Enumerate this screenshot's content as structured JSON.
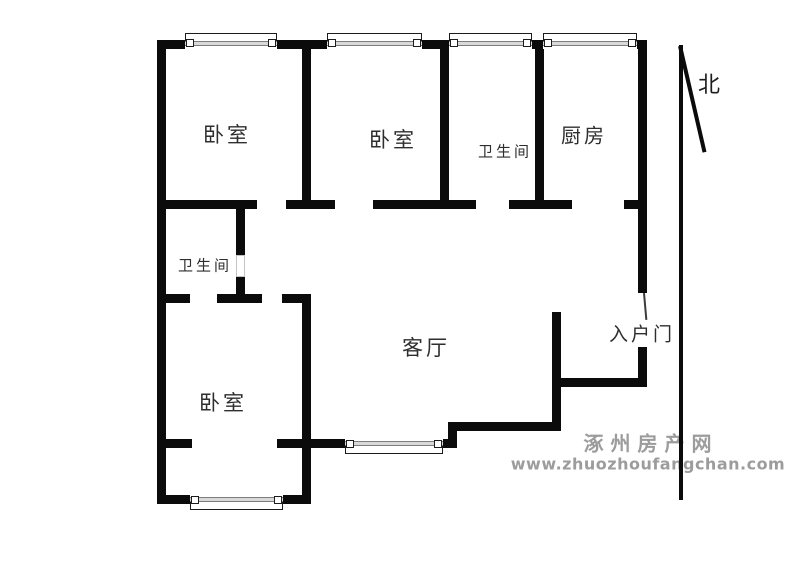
{
  "canvas": {
    "w": 800,
    "h": 570,
    "bg": "#ffffff"
  },
  "colors": {
    "wall": "#0b0b0b",
    "label": "#2e2e2e",
    "watermark": "#9c9c9c",
    "window_frame": "#1c1c1c",
    "window_glass": "#7d7d7d",
    "door_outline": "#c4c4c4"
  },
  "rooms": [
    {
      "name": "bedroom-northwest",
      "label": "卧室",
      "cx": 227,
      "cy": 134,
      "fs": 21
    },
    {
      "name": "bedroom-north",
      "label": "卧室",
      "cx": 393,
      "cy": 139,
      "fs": 21
    },
    {
      "name": "bathroom-north",
      "label": "卫生间",
      "cx": 505,
      "cy": 151,
      "fs": 15
    },
    {
      "name": "kitchen",
      "label": "厨房",
      "cx": 584,
      "cy": 134,
      "fs": 20
    },
    {
      "name": "bathroom-west",
      "label": "卫生间",
      "cx": 205,
      "cy": 265,
      "fs": 15
    },
    {
      "name": "bedroom-southwest",
      "label": "卧室",
      "cx": 223,
      "cy": 402,
      "fs": 21
    },
    {
      "name": "living-room",
      "label": "客厅",
      "cx": 426,
      "cy": 347,
      "fs": 21
    },
    {
      "name": "entry-door",
      "label": "入户门",
      "cx": 642,
      "cy": 333,
      "fs": 19
    }
  ],
  "north": {
    "label": "北",
    "cx": 709,
    "cy": 83,
    "vline": {
      "x": 679,
      "y": 45,
      "w": 4,
      "h": 455
    },
    "dline": {
      "x": 678,
      "y": 46,
      "w": 4,
      "h": 109,
      "angle": -13
    }
  },
  "walls": [
    {
      "x": 157,
      "y": 40,
      "w": 28,
      "h": 9
    },
    {
      "x": 277,
      "y": 40,
      "w": 50,
      "h": 9
    },
    {
      "x": 422,
      "y": 40,
      "w": 27,
      "h": 9
    },
    {
      "x": 532,
      "y": 40,
      "w": 11,
      "h": 9
    },
    {
      "x": 637,
      "y": 40,
      "w": 10,
      "h": 9
    },
    {
      "x": 157,
      "y": 40,
      "w": 9,
      "h": 464
    },
    {
      "x": 638,
      "y": 40,
      "w": 9,
      "h": 253
    },
    {
      "x": 302,
      "y": 49,
      "w": 9,
      "h": 151
    },
    {
      "x": 440,
      "y": 49,
      "w": 9,
      "h": 151
    },
    {
      "x": 535,
      "y": 49,
      "w": 9,
      "h": 151
    },
    {
      "x": 157,
      "y": 200,
      "w": 100,
      "h": 9
    },
    {
      "x": 286,
      "y": 200,
      "w": 49,
      "h": 9
    },
    {
      "x": 373,
      "y": 200,
      "w": 103,
      "h": 9
    },
    {
      "x": 509,
      "y": 200,
      "w": 63,
      "h": 9
    },
    {
      "x": 624,
      "y": 200,
      "w": 23,
      "h": 9
    },
    {
      "x": 236,
      "y": 209,
      "w": 9,
      "h": 46
    },
    {
      "x": 236,
      "y": 277,
      "w": 9,
      "h": 17
    },
    {
      "x": 157,
      "y": 294,
      "w": 33,
      "h": 9
    },
    {
      "x": 217,
      "y": 294,
      "w": 45,
      "h": 9
    },
    {
      "x": 282,
      "y": 294,
      "w": 29,
      "h": 9
    },
    {
      "x": 302,
      "y": 303,
      "w": 9,
      "h": 201
    },
    {
      "x": 157,
      "y": 439,
      "w": 35,
      "h": 9
    },
    {
      "x": 277,
      "y": 439,
      "w": 68,
      "h": 9
    },
    {
      "x": 443,
      "y": 439,
      "w": 14,
      "h": 9
    },
    {
      "x": 448,
      "y": 422,
      "w": 9,
      "h": 17
    },
    {
      "x": 457,
      "y": 422,
      "w": 104,
      "h": 9
    },
    {
      "x": 552,
      "y": 312,
      "w": 9,
      "h": 119
    },
    {
      "x": 552,
      "y": 378,
      "w": 95,
      "h": 9
    },
    {
      "x": 638,
      "y": 347,
      "w": 9,
      "h": 40
    },
    {
      "x": 157,
      "y": 495,
      "w": 33,
      "h": 9
    },
    {
      "x": 283,
      "y": 495,
      "w": 28,
      "h": 9
    }
  ],
  "doors": [
    {
      "name": "bathroom-west-door-opening",
      "x": 236,
      "y": 255,
      "w": 9,
      "h": 22
    }
  ],
  "door_leaf": {
    "name": "entry-door-leaf",
    "x": 643,
    "y": 293,
    "w": 2,
    "h": 27,
    "angle": -5
  },
  "windows": [
    {
      "x": 185,
      "w": 92,
      "wallY": 40,
      "side": "top"
    },
    {
      "x": 327,
      "w": 95,
      "wallY": 40,
      "side": "top"
    },
    {
      "x": 449,
      "w": 83,
      "wallY": 40,
      "side": "top"
    },
    {
      "x": 543,
      "w": 94,
      "wallY": 40,
      "side": "top"
    },
    {
      "x": 190,
      "w": 93,
      "wallY": 495,
      "side": "bottom"
    },
    {
      "x": 345,
      "w": 98,
      "wallY": 439,
      "side": "bottom"
    }
  ],
  "watermark": {
    "line1": "涿州房产网",
    "line2": "www.zhuozhoufangchan.com",
    "cx1": 651,
    "cy1": 442,
    "cx2": 648,
    "cy2": 464
  }
}
